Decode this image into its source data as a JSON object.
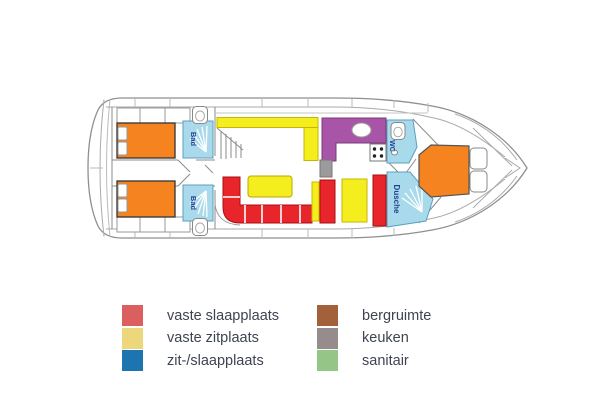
{
  "plan": {
    "labels": {
      "bad_top": "Bad",
      "bad_bottom": "Bad",
      "wc": "WC",
      "dusche": "Dusche"
    },
    "colors": {
      "bed": "#f5831f",
      "seat_red": "#e8252a",
      "seat_yellow": "#f5ee1e",
      "galley": "#a855a8",
      "wet_room": "#a9daeb",
      "label_text": "#224193",
      "pillar": "#9b9b9b"
    }
  },
  "legend": {
    "items": [
      {
        "label": "vaste slaapplaats",
        "color": "#dc5f5f"
      },
      {
        "label": "vaste zitplaats",
        "color": "#ecd77d"
      },
      {
        "label": "zit-/slaapplaats",
        "color": "#1c74b0"
      },
      {
        "label": "bergruimte",
        "color": "#a3613b"
      },
      {
        "label": "keuken",
        "color": "#968c8c"
      },
      {
        "label": "sanitair",
        "color": "#95c687"
      }
    ]
  }
}
